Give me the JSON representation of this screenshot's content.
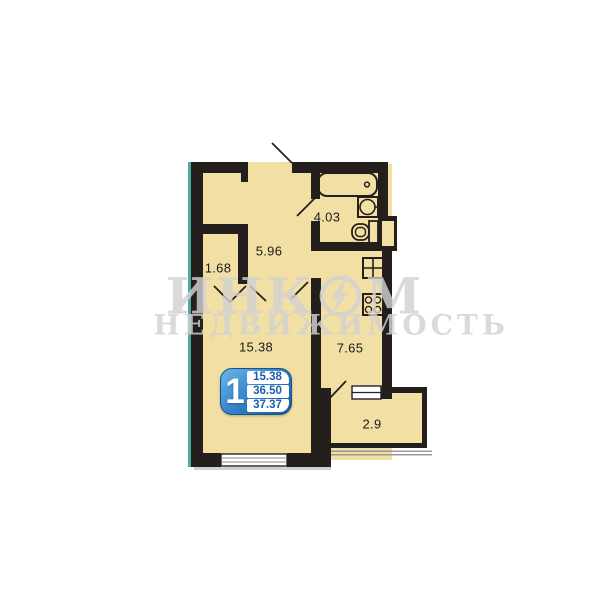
{
  "plan": {
    "rooms": {
      "hallway": {
        "name": "hallway",
        "area": "5.96"
      },
      "bathroom": {
        "name": "bathroom",
        "area": "4.03"
      },
      "closet": {
        "name": "closet",
        "area": "1.68"
      },
      "living_room": {
        "name": "living room",
        "area": "15.38"
      },
      "kitchen": {
        "name": "kitchen",
        "area": "7.65"
      },
      "balcony": {
        "name": "balcony",
        "area": "2.9"
      }
    },
    "info_badge": {
      "room_count": "1",
      "living_area": "15.38",
      "floor_area": "36.50",
      "total_area": "37.37"
    }
  },
  "watermark": {
    "brand_left": "ИНК",
    "brand_right": "М",
    "tagline": "НЕДВИЖИМОСТЬ",
    "logo": "incom-circle-lightning"
  },
  "colors": {
    "wall": "#241f1c",
    "floor": "#f2dfa4",
    "exterior_edge_teal": "#4ba9a1",
    "badge_blue_light": "#6ab6ea",
    "badge_blue_dark": "#1a569e",
    "badge_number_blue": "#1b5ea9",
    "watermark_gray": "#d2d2d2",
    "background": "#ffffff"
  }
}
